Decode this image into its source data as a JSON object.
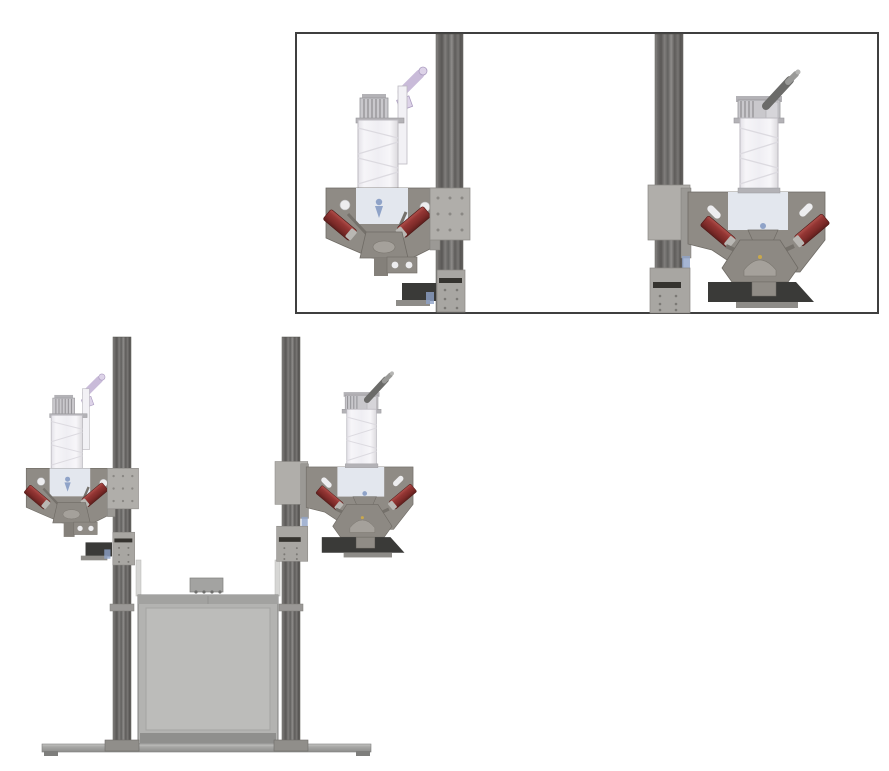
{
  "canvas": {
    "width": 889,
    "height": 771,
    "background": "#ffffff"
  },
  "colors": {
    "background": "#ffffff",
    "inset_border": "#3f3f3f",
    "rail_stroke": "#55534f",
    "rail_collar": "#9a9896",
    "carriage": "#b0aeaa",
    "carriage_block": "#a8a6a2",
    "carriage_stroke": "#8a8884",
    "bracket": "#9b9995",
    "plate": "#8f8b85",
    "plate_edge": "#6f6b65",
    "panel_light": "#e3e7ee",
    "plate_hole": "#ededef",
    "syringe_body": "#f2f1f5",
    "syringe_stroke": "#bcbac0",
    "syringe_spiral": "#dcdae0",
    "cap": "#c9c8cc",
    "cap_stroke": "#97969a",
    "cap_top": "#b3b2b6",
    "lavender": "#c9bbd9",
    "lavender_light": "#ddd3e8",
    "lever_dark": "#6b6b69",
    "lever_tip": "#9a9a98",
    "clamp_tip": "#b9b7b3",
    "nozzle_blue": "#8fa3c8",
    "mech": "#8d8983",
    "mech_light": "#a5a19b",
    "mech_line": "#75716b",
    "dark_block": "#3a3a38",
    "label_strip": "#35332f",
    "foot": "#8e8c88",
    "box_fill": "#b3b3b1",
    "box_top": "#a2a2a0",
    "box_inner": "#bcbcba",
    "box_border": "#828280",
    "box_bottom": "#8f8f8d",
    "post": "#d6d6d4",
    "base_fill": "#a8a8a6",
    "base_edge": "#7e7e7c",
    "gold_dot": "#c9a84c",
    "clamp_red": "#943634"
  },
  "detail_inset": {
    "name": "printhead-detail-inset",
    "border_color": "#3f3f3f",
    "views": [
      {
        "name": "left-printhead-detail",
        "parts": [
          "syringe-barrel",
          "syringe-cap",
          "luer-connector",
          "mounting-plate",
          "clamp-actuator-left",
          "clamp-actuator-right",
          "nozzle",
          "linkage-mechanism",
          "z-axis-rail",
          "rail-carriage",
          "carriage-label"
        ]
      },
      {
        "name": "right-printhead-detail",
        "parts": [
          "syringe-barrel",
          "syringe-cap",
          "lever-handle",
          "mounting-plate",
          "clamp-actuator-left",
          "clamp-actuator-right",
          "nozzle",
          "linkage-mechanism",
          "collection-block",
          "z-axis-rail",
          "rail-carriage",
          "carriage-label"
        ]
      }
    ]
  },
  "machine": {
    "name": "dual-printhead-gantry-front-view",
    "parts": [
      "left-z-axis-column",
      "right-z-axis-column",
      "left-printhead",
      "right-printhead",
      "build-chamber",
      "chamber-top-bracket",
      "corner-posts",
      "base-plate",
      "base-feet"
    ]
  }
}
